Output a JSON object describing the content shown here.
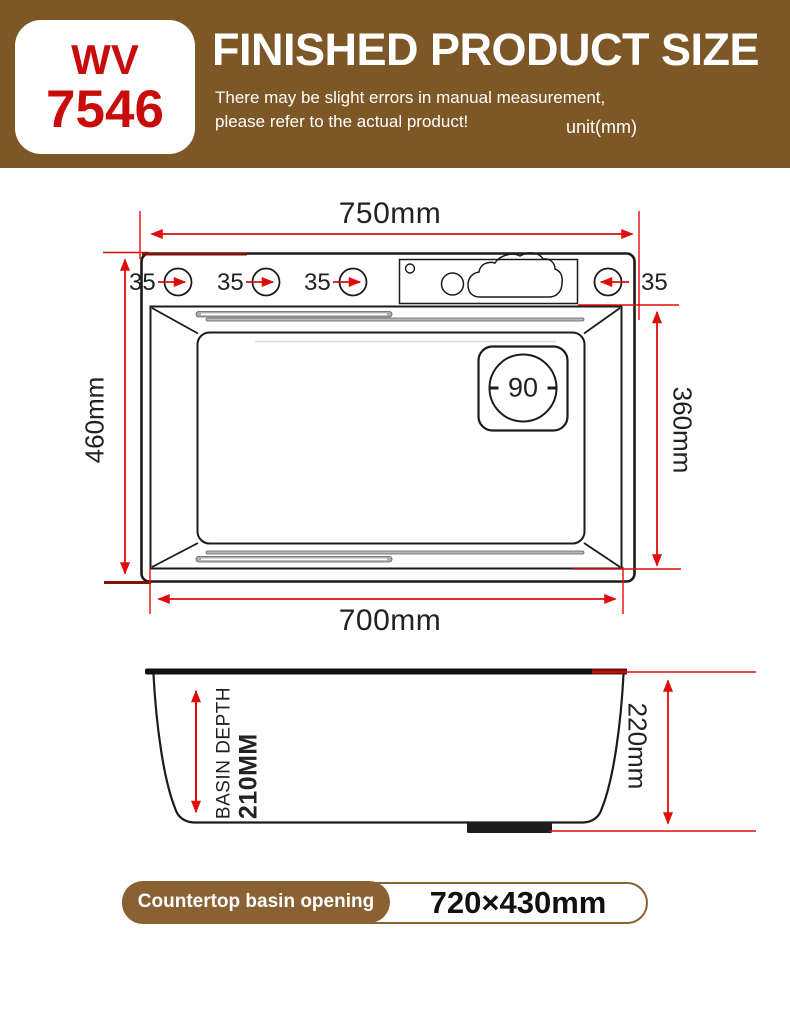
{
  "header": {
    "model_line1": "WV",
    "model_line2": "7546",
    "title": "FINISHED PRODUCT SIZE",
    "subtitle_line1": "There may be slight errors in manual measurement,",
    "subtitle_line2": "please refer to the actual product!",
    "unit": "unit(mm)"
  },
  "top_view": {
    "width_total": "750mm",
    "hole_labels": [
      "35",
      "35",
      "35",
      "35"
    ],
    "height_total": "460mm",
    "basin_height": "360mm",
    "drain_diameter": "90",
    "width_bottom": "700mm"
  },
  "side_view": {
    "depth_label_line1": "BASIN DEPTH",
    "depth_label_line2": "210MM",
    "height_total": "220mm"
  },
  "footer": {
    "badge_label": "Countertop basin opening",
    "badge_value": "720×430mm"
  },
  "colors": {
    "brown": "#7d5826",
    "badge-brown": "#8a6132",
    "red": "#e00c0c",
    "model-red": "#c80c0c",
    "ink": "#1b1b1b"
  }
}
